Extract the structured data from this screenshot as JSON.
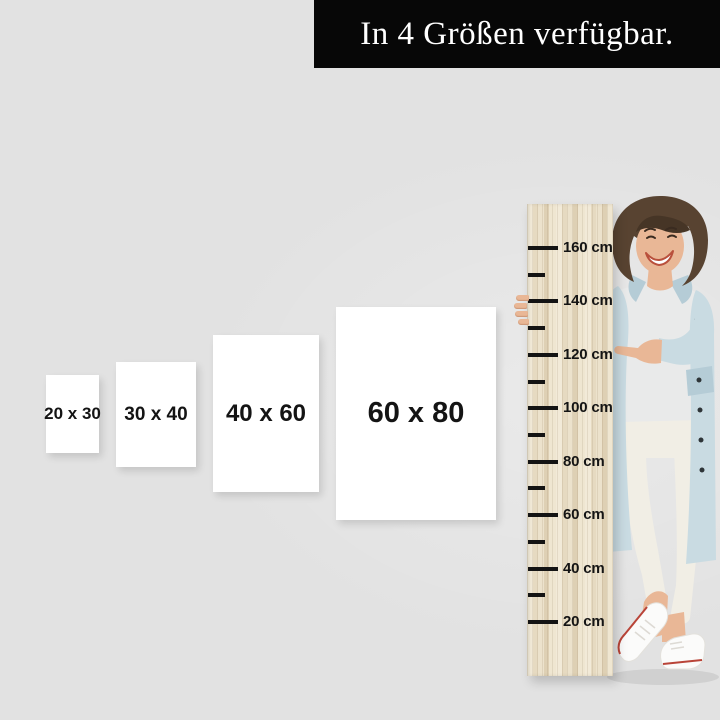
{
  "banner": {
    "text": "In 4 Größen verfügbar."
  },
  "sizes": {
    "items": [
      {
        "label": "20 x 30"
      },
      {
        "label": "30 x 40"
      },
      {
        "label": "40 x 60"
      },
      {
        "label": "60 x 80"
      }
    ]
  },
  "ruler": {
    "unit": "cm",
    "ticks": [
      {
        "value": 160,
        "label": "160 cm",
        "major": true
      },
      {
        "value": 150,
        "label": "",
        "major": false
      },
      {
        "value": 140,
        "label": "140 cm",
        "major": true
      },
      {
        "value": 130,
        "label": "",
        "major": false
      },
      {
        "value": 120,
        "label": "120 cm",
        "major": true
      },
      {
        "value": 110,
        "label": "",
        "major": false
      },
      {
        "value": 100,
        "label": "100 cm",
        "major": true
      },
      {
        "value": 90,
        "label": "",
        "major": false
      },
      {
        "value": 80,
        "label": "80 cm",
        "major": true
      },
      {
        "value": 70,
        "label": "",
        "major": false
      },
      {
        "value": 60,
        "label": "60 cm",
        "major": true
      },
      {
        "value": 50,
        "label": "",
        "major": false
      },
      {
        "value": 40,
        "label": "40 cm",
        "major": true
      },
      {
        "value": 30,
        "label": "",
        "major": false
      },
      {
        "value": 20,
        "label": "20 cm",
        "major": true
      }
    ]
  },
  "colors": {
    "background": "#e2e2e2",
    "banner_bg": "#070707",
    "banner_text": "#ffffff",
    "size_box_bg": "#ffffff",
    "size_label": "#141414",
    "wood_base": "#e9dfc9",
    "tick": "#141414",
    "denim_jacket": "#c9dbe2",
    "tshirt": "#e9eaea",
    "pants": "#f1eee5",
    "skin": "#e9b796",
    "hair": "#584331",
    "shoe": "#fbfbfa",
    "shoe_stripe": "#b94438"
  }
}
